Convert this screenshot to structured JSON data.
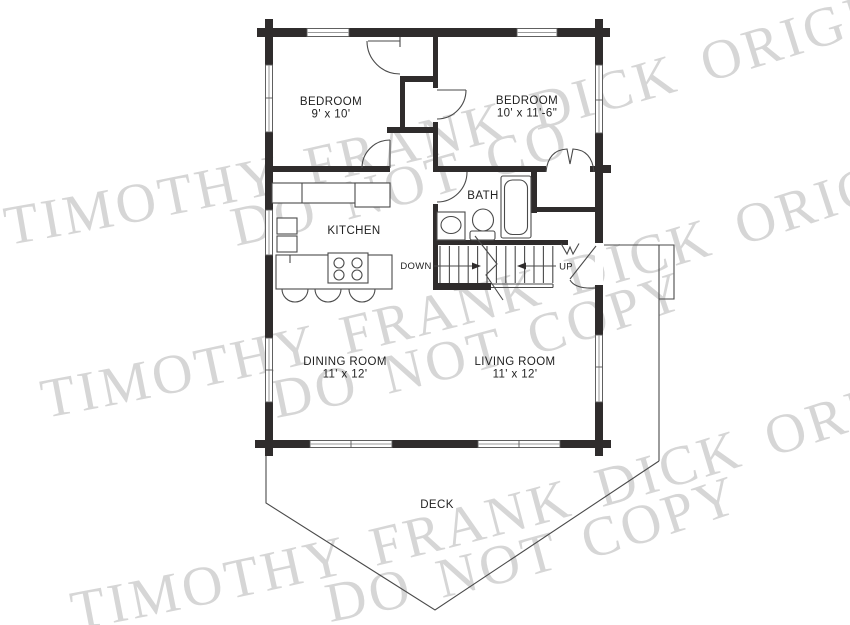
{
  "watermark": {
    "line1": "TIMOTHY FRANK DICK ORIGINALS",
    "line2": "DO NOT COPY",
    "color": "#d6d6d6"
  },
  "rooms": {
    "bedroom1": {
      "name": "BEDROOM",
      "dims": "9' x 10'"
    },
    "bedroom2": {
      "name": "BEDROOM",
      "dims": "10' x 11'-6\""
    },
    "kitchen": {
      "name": "KITCHEN"
    },
    "bath": {
      "name": "BATH"
    },
    "dining": {
      "name": "DINING ROOM",
      "dims": "11' x 12'"
    },
    "living": {
      "name": "LIVING ROOM",
      "dims": "11' x 12'"
    },
    "deck": {
      "name": "DECK"
    }
  },
  "stairs": {
    "down": "DOWN",
    "up": "UP"
  },
  "colors": {
    "wall": "#2f2c2c",
    "line": "#4a4a4a"
  }
}
